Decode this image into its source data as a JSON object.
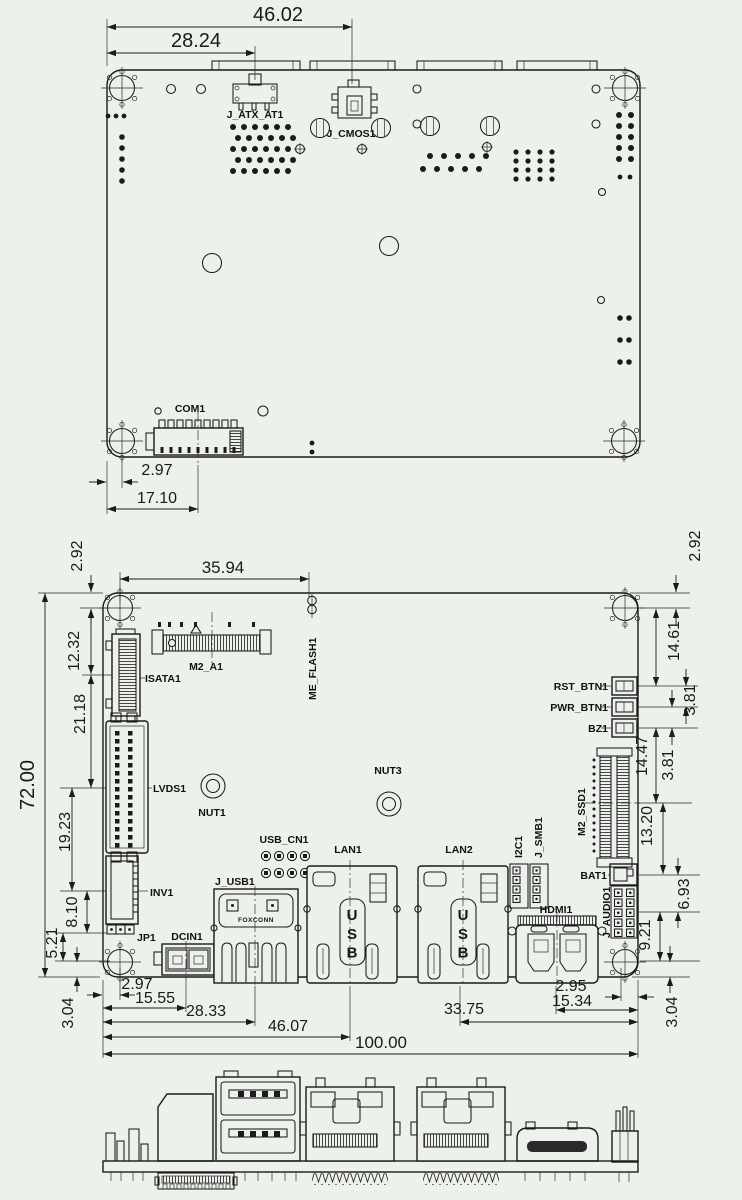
{
  "top_view": {
    "labels": {
      "j_atx_at1": "J_ATX_AT1",
      "j_cmos1": "J_CMOS1",
      "com1": "COM1"
    },
    "dims": {
      "cmos_from_edge": "46.02",
      "atx_from_edge": "28.24",
      "com1_edge_offset": "2.97",
      "com1_center": "17.10"
    }
  },
  "bottom_view": {
    "labels": {
      "isata1": "ISATA1",
      "m2_a1": "M2_A1",
      "me_flash1": "ME_FLASH1",
      "lvds1": "LVDS1",
      "nut1": "NUT1",
      "nut3": "NUT3",
      "inv1": "INV1",
      "jp1": "JP1",
      "dcin1": "DCIN1",
      "usb_cn1": "USB_CN1",
      "j_usb1": "J_USB1",
      "foxconn": "FOXCONN",
      "lan1": "LAN1",
      "lan2": "LAN2",
      "i2c1": "I2C1",
      "j_smb1": "J_SMB1",
      "hdmi1": "HDMI1",
      "m2_ssd1": "M2_SSD1",
      "rst_btn1": "RST_BTN1",
      "pwr_btn1": "PWR_BTN1",
      "bz1": "BZ1",
      "bat1": "BAT1",
      "j_audio1": "J_AUDIO1",
      "usb_marking": "USB"
    },
    "dims_left": {
      "board_height": "72.00",
      "edge_to_hole": "2.92",
      "hole_to_isata": "12.32",
      "isata_to_lvds": "21.18",
      "lvds_to_inv": "19.23",
      "inv_to_jp": "8.10",
      "jp_to_hole": "5.21",
      "hole_to_edge": "3.04"
    },
    "dims_top": {
      "hole_to_meflash": "35.94"
    },
    "dims_right": {
      "edge_to_hole": "2.92",
      "hole_to_rst": "14.61",
      "rst_to_pwr": "3.81",
      "bz_to_ssd": "14.47",
      "pwr_to_bz": "3.81",
      "ssd_to_bat": "13.20",
      "bat_to_audio": "6.93",
      "audio_to_hole": "9.21",
      "hole_to_edge": "3.04"
    },
    "dims_bottom": {
      "edge_to_hole": "2.97",
      "dcin_center": "15.55",
      "usb_center": "28.33",
      "lan1_center": "46.07",
      "lan2_to_edge": "33.75",
      "hole_to_edge": "2.95",
      "hdmi_to_edge": "15.34",
      "board_width": "100.00"
    }
  }
}
